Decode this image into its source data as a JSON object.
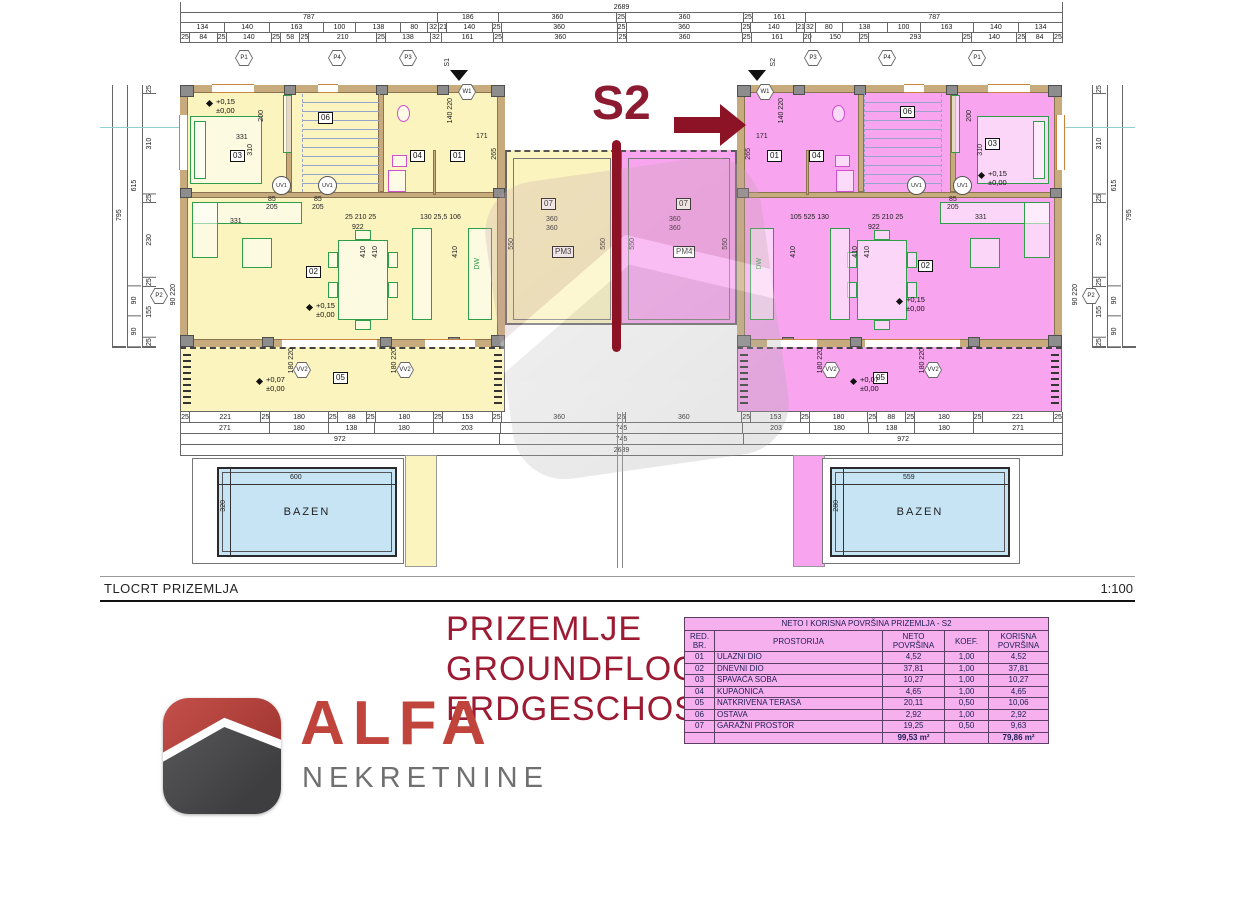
{
  "headline": {
    "unit": "S2"
  },
  "title_block": {
    "name": "TLOCRT PRIZEMLJA",
    "scale": "1:100"
  },
  "subtitle": {
    "hr": "PRIZEMLJE",
    "en": "GROUNDFLOOR",
    "de": "ERDGESCHOSS"
  },
  "logo": {
    "brand": "ALFA",
    "tagline": "NEKRETNINE"
  },
  "rooms": {
    "entry": "01",
    "living": "02",
    "bedroom": "03",
    "bath": "04",
    "terrace": "05",
    "storage": "06",
    "garage": "07",
    "pm_left": "PM3",
    "pm_right": "PM4"
  },
  "levels": {
    "up": "+0,15",
    "zero": "±0,00",
    "terrace_up": "+0,07"
  },
  "pool": {
    "label": "BAZEN",
    "left_w": "600",
    "left_h": "320",
    "right_w": "559",
    "right_h": "280"
  },
  "markers": {
    "top_left": [
      "P1",
      "P4",
      "P3"
    ],
    "top_right": [
      "P3",
      "P4",
      "P1"
    ],
    "side": "P2",
    "entry_left": "S1",
    "entry_right": "S2",
    "w": "W1",
    "vv": "VV2",
    "uv": "UV1",
    "dw": "DW"
  },
  "inner_dims": {
    "bed_w": "331",
    "bed_d": "310",
    "bed_h": "200",
    "living_span": "922",
    "living_a": "25 210 25",
    "living_b": "130 25,5 106",
    "living_c": "105 525 130",
    "col": "410",
    "garage_w": "360",
    "garage_d": "550",
    "entry_d": "265",
    "entry_w": "171",
    "door_pair": "140 220",
    "vv_pair": "180 220",
    "bath_a": "85",
    "bath_b": "205",
    "p2_pair": "90 220"
  },
  "dims": {
    "top_total": [
      "2689"
    ],
    "top_row2": [
      "787",
      "186",
      "360",
      "25",
      "360",
      "25",
      "161",
      "787"
    ],
    "top_row3": [
      "134",
      "140",
      "163",
      "100",
      "138",
      "80",
      "32",
      "21",
      "140",
      "25",
      "360",
      "25",
      "360",
      "25",
      "140",
      "21",
      "32",
      "80",
      "138",
      "100",
      "163",
      "140",
      "134"
    ],
    "top_row4": [
      "25",
      "84",
      "25",
      "140",
      "25",
      "58",
      "25",
      "210",
      "25",
      "138",
      "32",
      "161",
      "25",
      "360",
      "25",
      "360",
      "25",
      "161",
      "20",
      "150",
      "25",
      "293",
      "25",
      "140",
      "25",
      "84",
      "25"
    ],
    "bottom_rowA": [
      "25",
      "221",
      "25",
      "180",
      "25",
      "88",
      "25",
      "180",
      "25",
      "153",
      "25",
      "360",
      "25",
      "360",
      "25",
      "153",
      "25",
      "180",
      "25",
      "88",
      "25",
      "180",
      "25",
      "221",
      "25"
    ],
    "bottom_rowB": [
      "271",
      "180",
      "138",
      "180",
      "203",
      "745",
      "203",
      "180",
      "138",
      "180",
      "271"
    ],
    "bottom_rowC": [
      "972",
      "745",
      "972"
    ],
    "bottom_total": [
      "2689"
    ],
    "left_col_a": [
      "795"
    ],
    "left_col_b": [
      "615",
      "90",
      "90"
    ],
    "left_col_c": [
      "25",
      "310",
      "25",
      "230",
      "25",
      "155",
      "25"
    ],
    "right_col_a": [
      "795"
    ],
    "right_col_b": [
      "615",
      "90",
      "90"
    ],
    "right_col_c": [
      "25",
      "310",
      "25",
      "230",
      "25",
      "155",
      "25"
    ]
  },
  "area_table": {
    "title": "NETO I KORISNA POVRŠINA PRIZEMLJA - S2",
    "headers": [
      "RED. BR.",
      "PROSTORIJA",
      "NETO POVRŠINA",
      "KOEF.",
      "KORISNA POVRŠINA"
    ],
    "rows": [
      [
        "01",
        "ULAZNI DIO",
        "4,52",
        "1,00",
        "4,52"
      ],
      [
        "02",
        "DNEVNI DIO",
        "37,81",
        "1,00",
        "37,81"
      ],
      [
        "03",
        "SPAVAĆA SOBA",
        "10,27",
        "1,00",
        "10,27"
      ],
      [
        "04",
        "KUPAONICA",
        "4,65",
        "1,00",
        "4,65"
      ],
      [
        "05",
        "NATKRIVENA TERASA",
        "20,11",
        "0,50",
        "10,06"
      ],
      [
        "06",
        "OSTAVA",
        "2,92",
        "1,00",
        "2,92"
      ],
      [
        "07",
        "GARAŽNI PROSTOR",
        "19,25",
        "0,50",
        "9,63"
      ]
    ],
    "total_neto": "99,53 m²",
    "total_korisna": "79,86 m²"
  }
}
